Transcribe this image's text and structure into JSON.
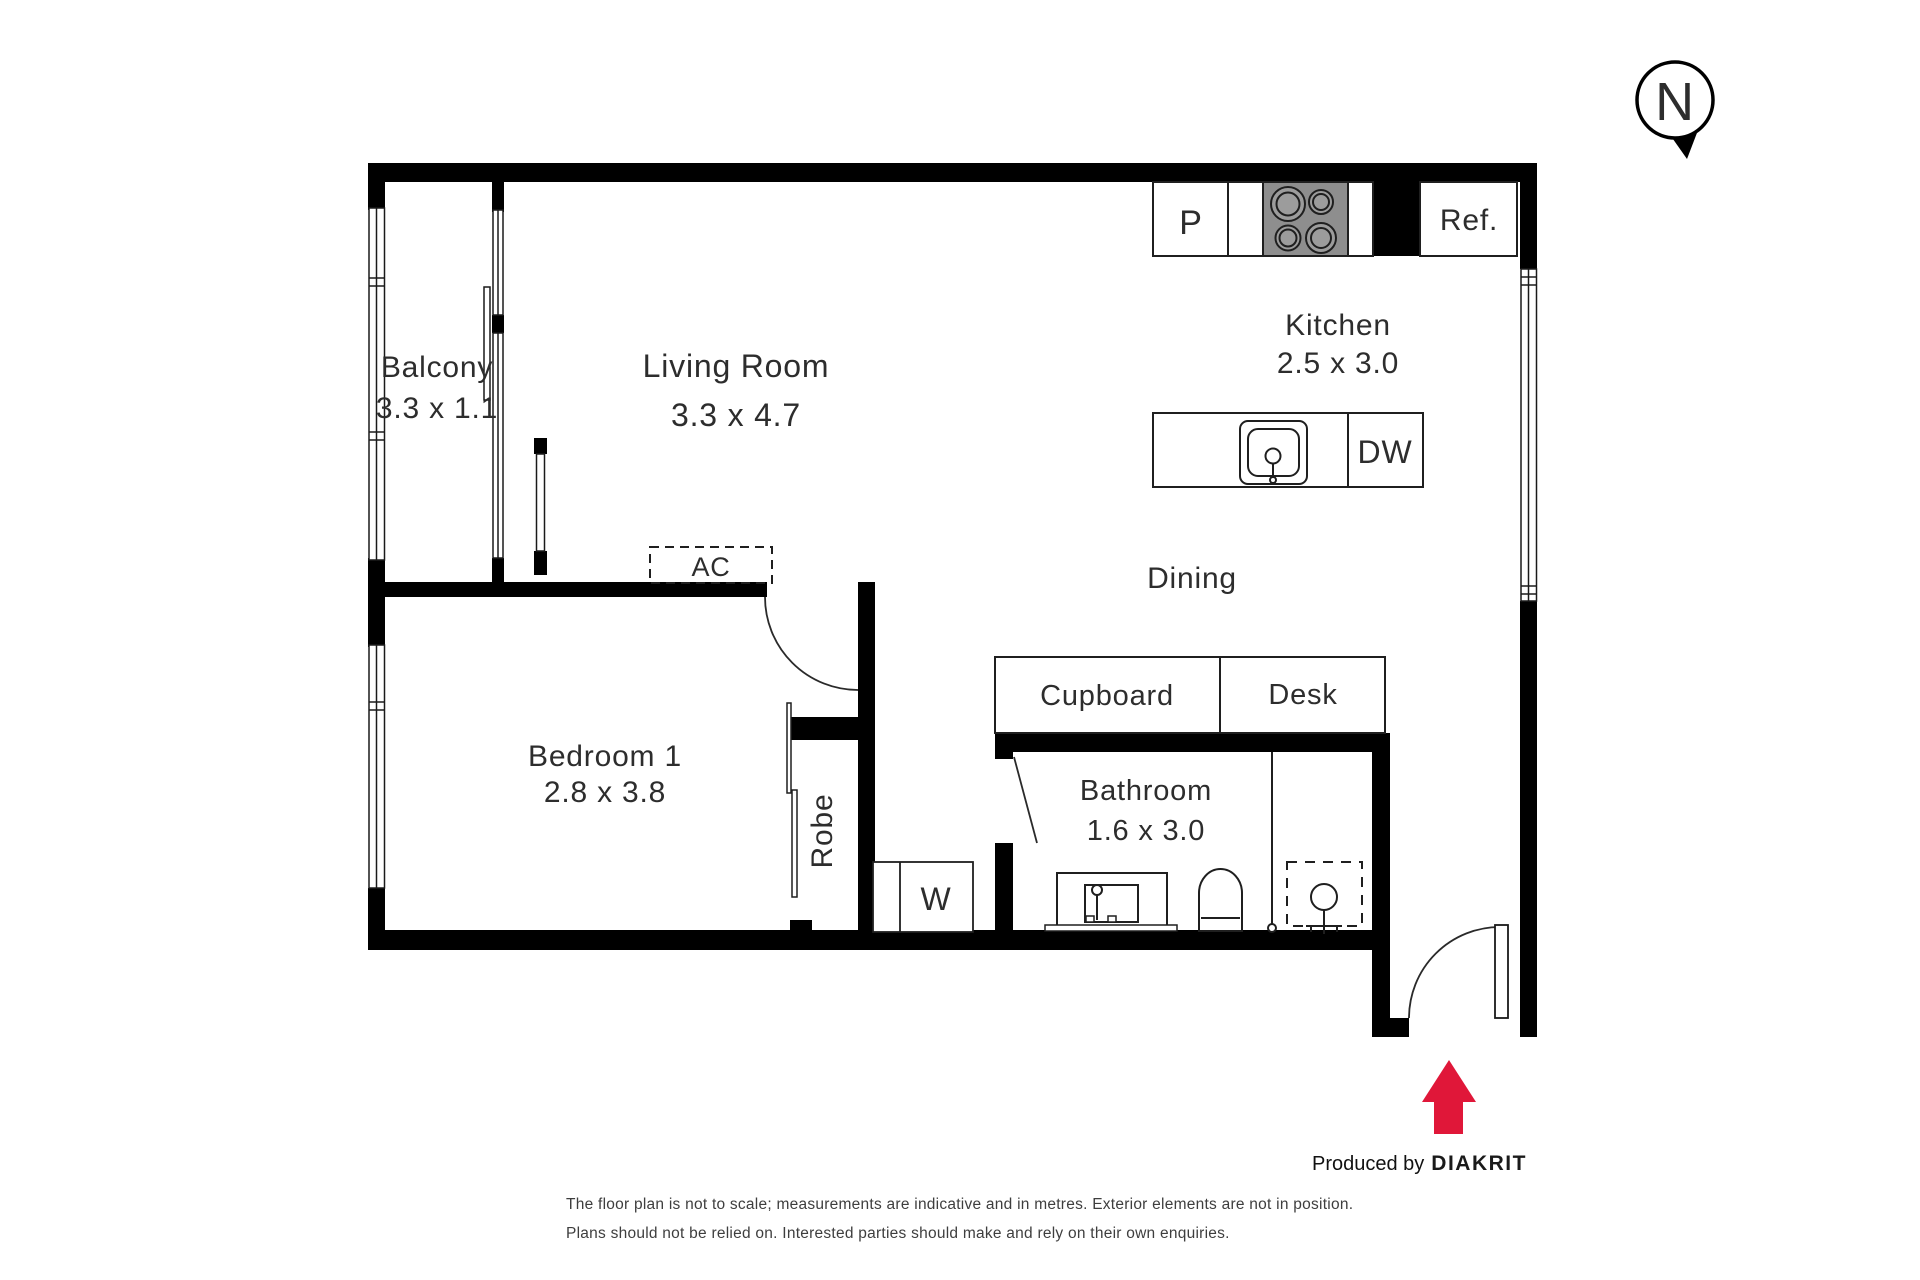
{
  "compass": {
    "north_label": "N"
  },
  "rooms": {
    "balcony": {
      "name": "Balcony",
      "dims": "3.3 x 1.1"
    },
    "living": {
      "name": "Living Room",
      "dims": "3.3 x 4.7"
    },
    "kitchen": {
      "name": "Kitchen",
      "dims": "2.5 x 3.0"
    },
    "dining": {
      "name": "Dining"
    },
    "bedroom1": {
      "name": "Bedroom 1",
      "dims": "2.8 x 3.8"
    },
    "bathroom": {
      "name": "Bathroom",
      "dims": "1.6 x 3.0"
    }
  },
  "fixtures": {
    "pantry": "P",
    "refrigerator": "Ref.",
    "dishwasher": "DW",
    "air_conditioner": "AC",
    "cupboard": "Cupboard",
    "desk": "Desk",
    "robe": "Robe",
    "washer": "W"
  },
  "credit": {
    "produced_by": "Produced by",
    "brand": "DIAKRIT"
  },
  "disclaimer": {
    "line1": "The floor plan is not to scale; measurements are indicative and in metres. Exterior elements are not in position.",
    "line2": "Plans should not be relied on. Interested parties should make and rely on their own enquiries."
  },
  "colors": {
    "wall": "#000000",
    "arrow_red": "#e01739",
    "cooktop_gray": "#8e8e8e"
  }
}
